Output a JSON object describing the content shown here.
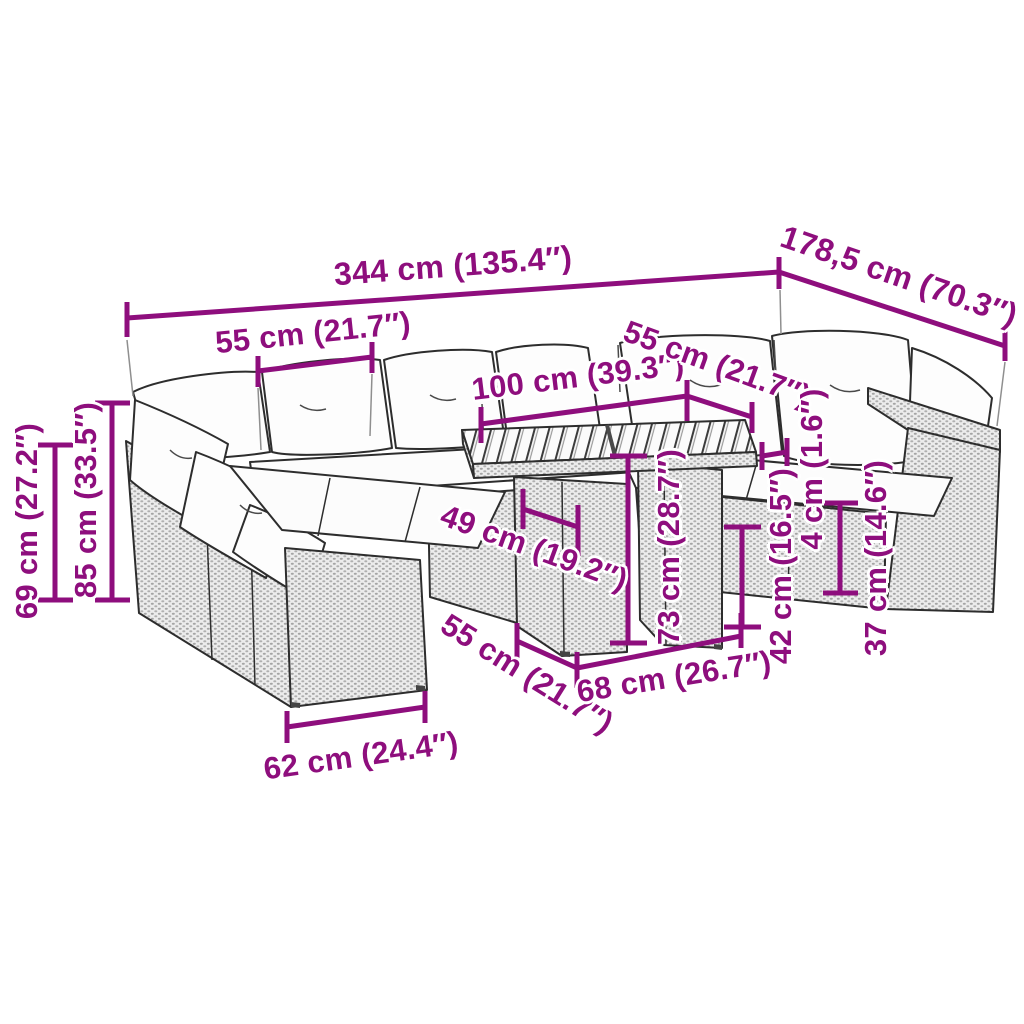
{
  "diagram": {
    "type": "furniture-dimension-diagram",
    "subject": "Garden lounge sofa set with table",
    "accent_color": "#8E0E7D",
    "dimensions": [
      {
        "id": "overall-width",
        "label": "344 cm (135.4″)"
      },
      {
        "id": "overall-depth",
        "label": "178,5 cm (70.3″)"
      },
      {
        "id": "seat-module-width-left",
        "label": "55 cm (21.7″)"
      },
      {
        "id": "back-section-width",
        "label": "100 cm (39.3″)"
      },
      {
        "id": "seat-module-width-right",
        "label": "55 cm (21.7″)"
      },
      {
        "id": "backrest-height",
        "label": "69 cm (27.2″)"
      },
      {
        "id": "total-height",
        "label": "85 cm (33.5″)"
      },
      {
        "id": "seat-depth",
        "label": "49 cm (19.2″)"
      },
      {
        "id": "table-height",
        "label": "73 cm (28.7″)"
      },
      {
        "id": "seat-height",
        "label": "42 cm (16.5″)"
      },
      {
        "id": "tabletop-thickness",
        "label": "4 cm (1.6″)"
      },
      {
        "id": "front-panel-height",
        "label": "37 cm (14.6″)"
      },
      {
        "id": "seat-front-width",
        "label": "62 cm (24.4″)"
      },
      {
        "id": "table-depth",
        "label": "55 cm (21.7″)"
      },
      {
        "id": "table-width",
        "label": "68 cm (26.7″)"
      }
    ]
  }
}
